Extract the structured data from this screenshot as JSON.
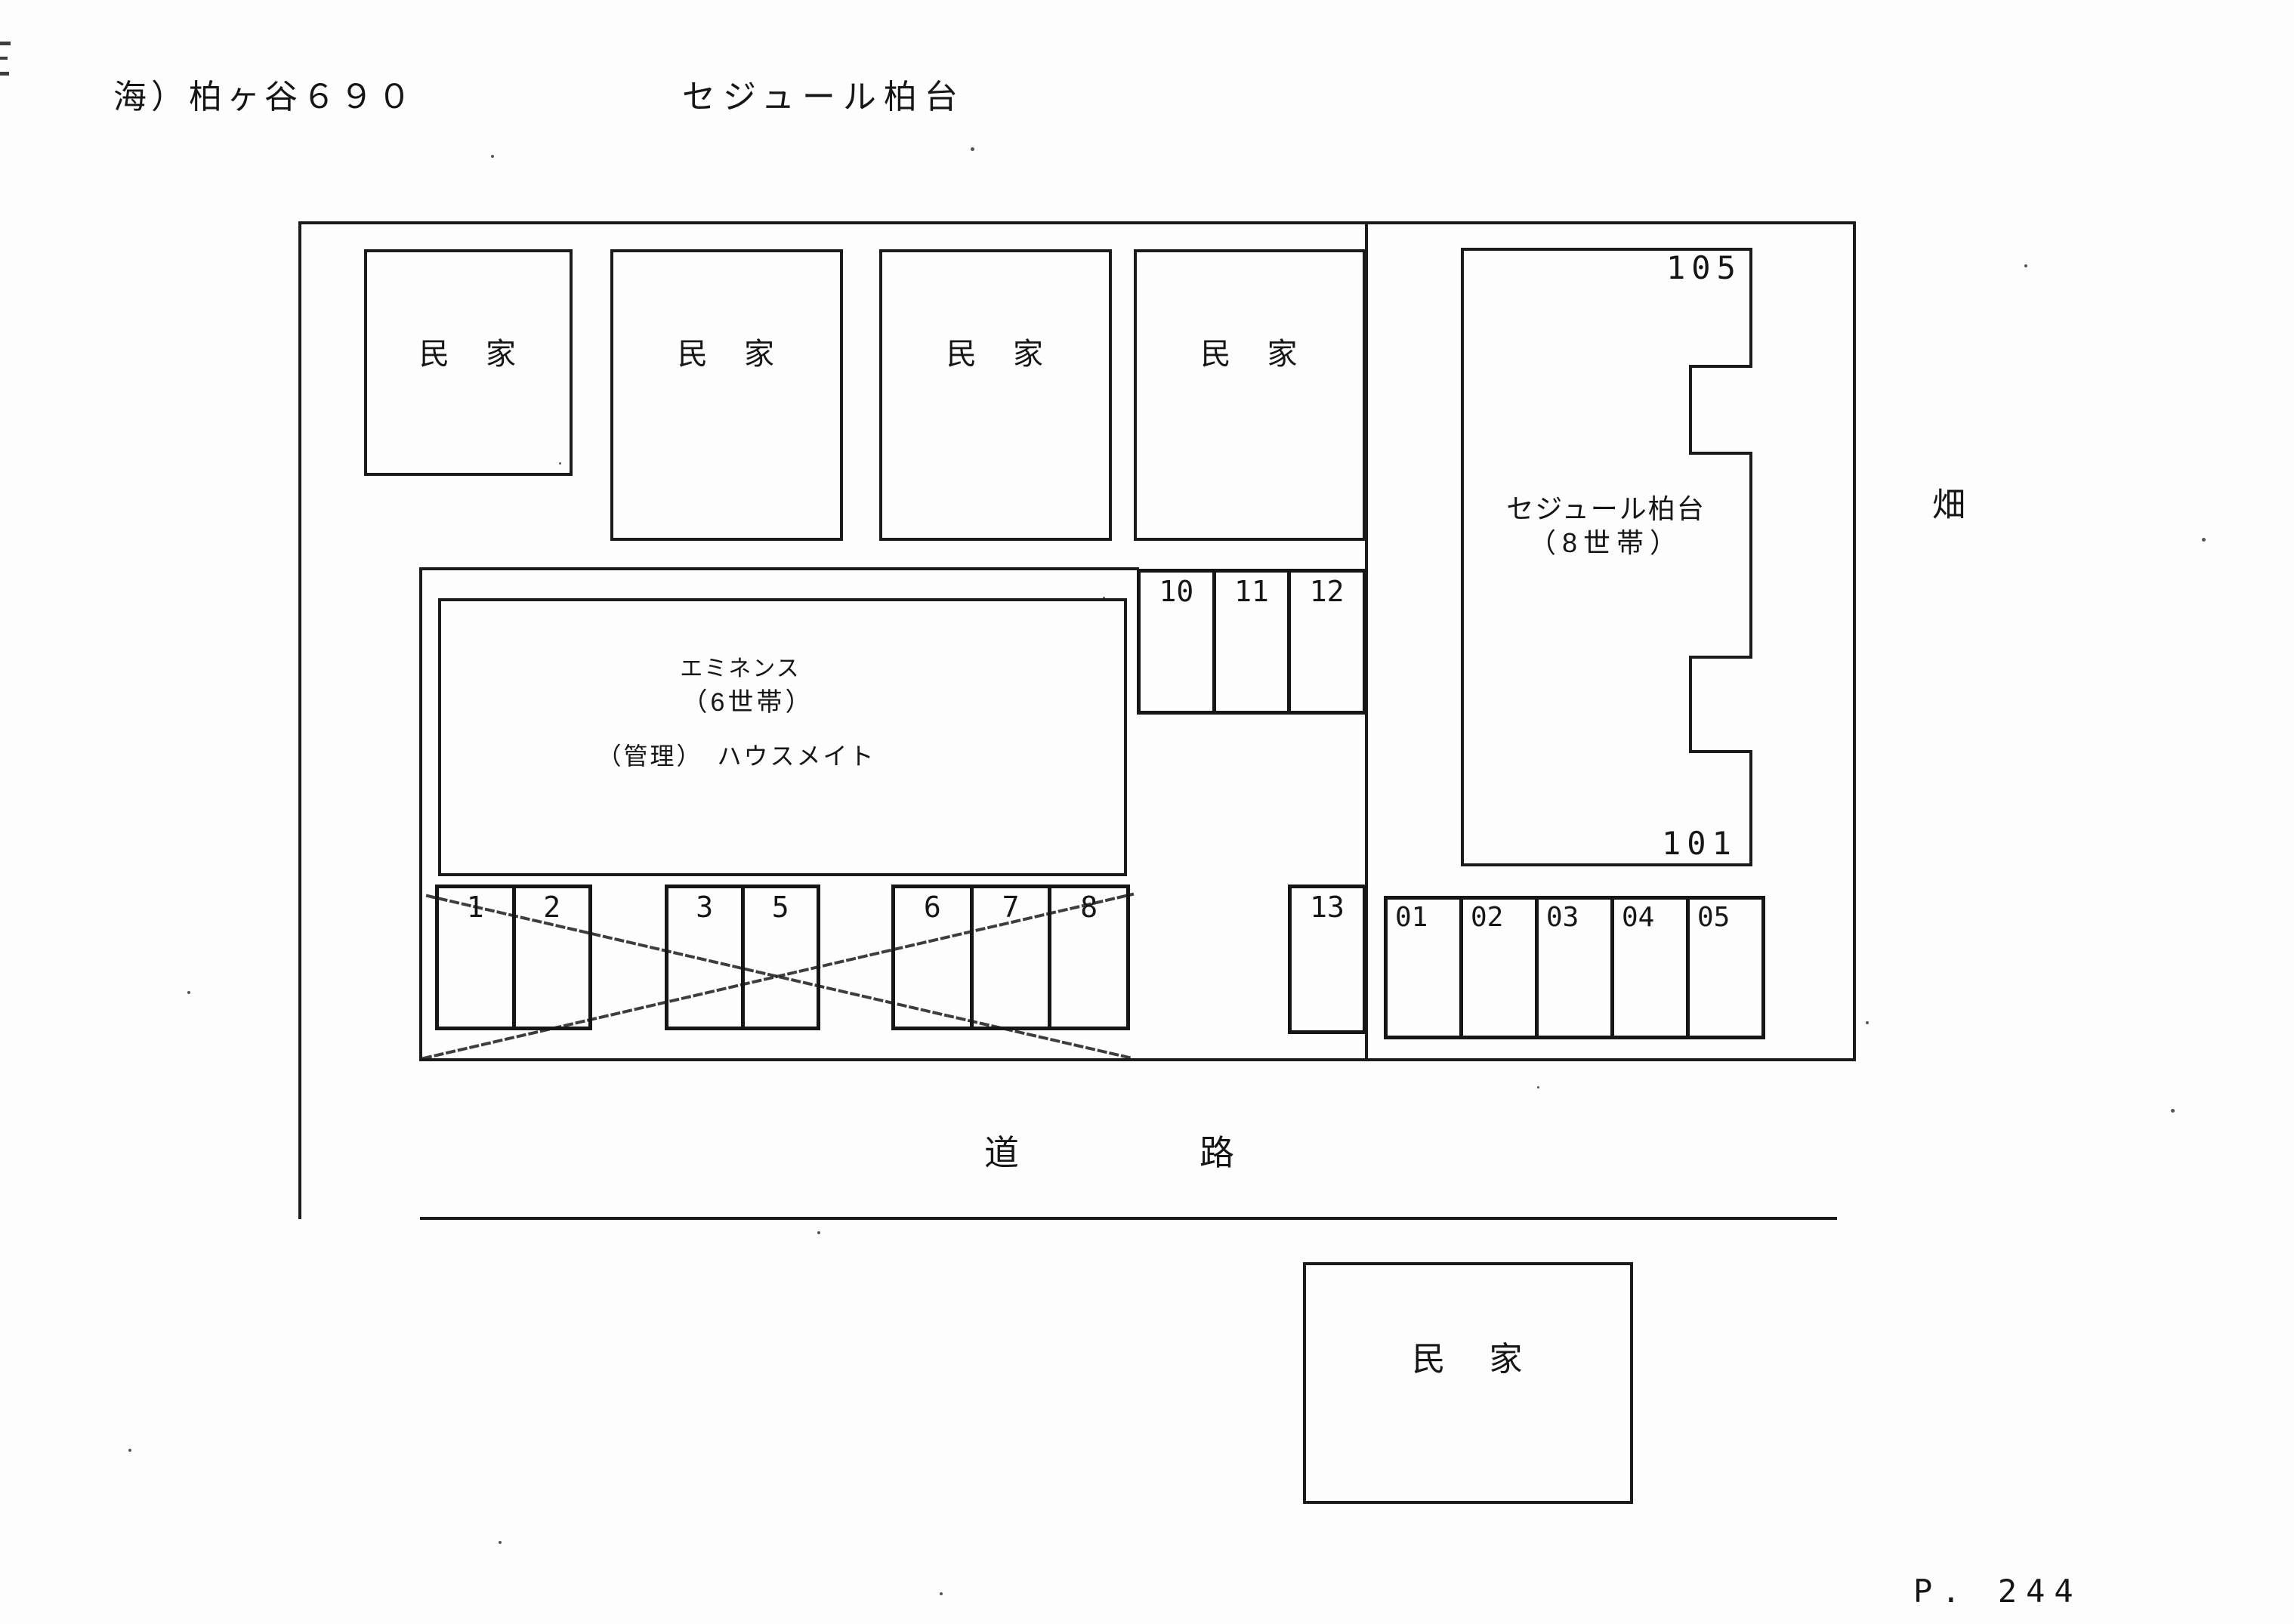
{
  "header": {
    "site_code": "海）柏ヶ谷６９０",
    "site_name": "セジュール柏台"
  },
  "map": {
    "house_label_first": "民",
    "house_label_second": "家",
    "field_label": "畑",
    "road_label_first": "道",
    "road_label_second": "路",
    "eminence": {
      "name": "エミネンス",
      "units": "（6世帯）",
      "management": "（管理）　ハウスメイト"
    },
    "sejour": {
      "name": "セジュール柏台",
      "units": "（8世帯）",
      "room_top": "105",
      "room_bottom": "101"
    },
    "parking": {
      "upper": [
        "10",
        "11",
        "12"
      ],
      "group_a": [
        "1",
        "2"
      ],
      "group_b": [
        "3",
        "5"
      ],
      "group_c": [
        "6",
        "7",
        "8"
      ],
      "single": "13",
      "east": [
        "01",
        "02",
        "03",
        "04",
        "05"
      ]
    }
  },
  "footer": {
    "page_number": "P. 244"
  }
}
